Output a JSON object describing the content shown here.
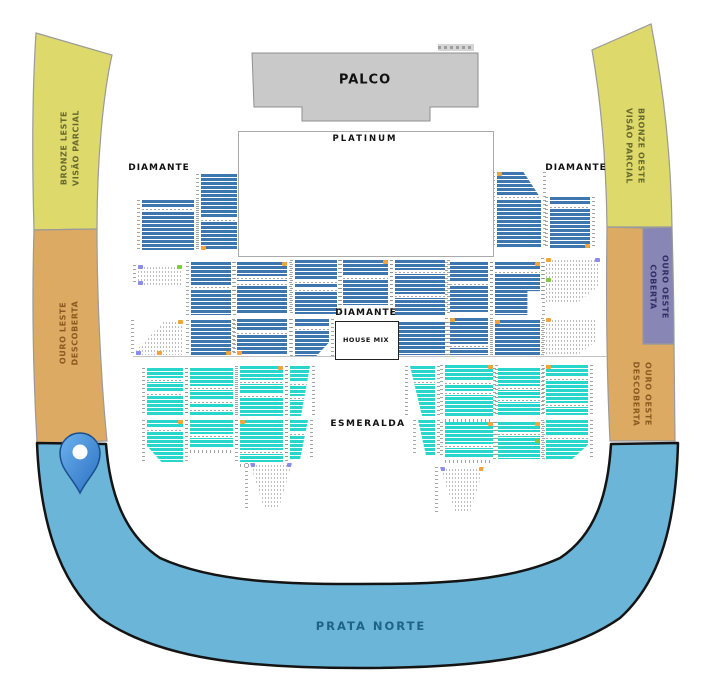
{
  "stage": {
    "label": "PALCO"
  },
  "sections": {
    "platinum": {
      "label": "PLATINUM"
    },
    "diamante_left": {
      "label": "DIAMANTE"
    },
    "diamante_right": {
      "label": "DIAMANTE"
    },
    "diamante_center": {
      "label": "DIAMANTE"
    },
    "house_mix": {
      "label": "HOUSE MIX"
    },
    "esmeralda": {
      "label": "ESMERALDA"
    },
    "prata_norte": {
      "label": "PRATA NORTE"
    },
    "bronze_leste": {
      "line1": "BRONZE LESTE",
      "line2": "VISÃO PARCIAL"
    },
    "bronze_oeste": {
      "line1": "BRONZE OESTE",
      "line2": "VISÃO PARCIAL"
    },
    "ouro_leste": {
      "line1": "OURO LESTE",
      "line2": "DESCOBERTA"
    },
    "ouro_oeste_coberta": {
      "line1": "OURO OESTE",
      "line2": "COBERTA"
    },
    "ouro_oeste_descoberta": {
      "line1": "OURO OESTE",
      "line2": "DESCOBERTA"
    }
  },
  "colors": {
    "gold": "#bf9c1c",
    "blue": "#3e76af",
    "cyan": "#28d7cc",
    "bronze_band": "#ddd96b",
    "ouro_band": "#dcaa63",
    "coberta_band": "#8886b4",
    "prata_band": "#6ab5d8",
    "stage_fill": "#c9c9c9",
    "pin_light": "#6db2ee",
    "pin_dark": "#2a6fc0",
    "pin_stroke": "#1b4e8c",
    "accent_orange": "#f2a33c",
    "accent_green": "#7ecb3f",
    "accent_purple": "#8b8bef"
  },
  "marker": {
    "name": "selected-location-pin"
  },
  "seat_blocks": [
    {
      "x": 245,
      "y": 152,
      "w": 40,
      "h": 48,
      "c": "gold",
      "shape": "cut-tl",
      "gaps": [
        16
      ],
      "acc": [
        [
          "tr",
          "o"
        ]
      ]
    },
    {
      "x": 293,
      "y": 148,
      "w": 42,
      "h": 52,
      "c": "gold",
      "gaps": [
        30
      ],
      "hd": "t"
    },
    {
      "x": 342,
      "y": 147,
      "w": 43,
      "h": 53,
      "c": "gold",
      "gaps": [
        5,
        10
      ],
      "hd": "t"
    },
    {
      "x": 393,
      "y": 148,
      "w": 42,
      "h": 52,
      "c": "gold",
      "gaps": [
        22,
        36
      ],
      "hd": "t"
    },
    {
      "x": 442,
      "y": 147,
      "w": 43,
      "h": 53,
      "c": "gold",
      "shape": "cut-tr",
      "gaps": [
        14
      ],
      "acc": [
        [
          "tl",
          "o"
        ]
      ]
    },
    {
      "x": 245,
      "y": 205,
      "w": 40,
      "h": 42,
      "c": "gold"
    },
    {
      "x": 293,
      "y": 205,
      "w": 42,
      "h": 42,
      "c": "gold",
      "gaps": [
        24
      ]
    },
    {
      "x": 342,
      "y": 205,
      "w": 43,
      "h": 42,
      "c": "gold",
      "gaps": [
        8
      ]
    },
    {
      "x": 393,
      "y": 205,
      "w": 42,
      "h": 42,
      "c": "gold",
      "gaps": [
        28
      ],
      "acc": [
        [
          "tr",
          "o"
        ]
      ]
    },
    {
      "x": 442,
      "y": 205,
      "w": 43,
      "h": 42,
      "c": "gold",
      "gaps": [
        16
      ]
    },
    {
      "x": 142,
      "y": 200,
      "w": 52,
      "h": 50,
      "c": "blue",
      "gaps": [
        7
      ]
    },
    {
      "x": 201,
      "y": 174,
      "w": 36,
      "h": 76,
      "c": "blue",
      "gaps": [
        44
      ],
      "acc": [
        [
          "bl",
          "o"
        ]
      ]
    },
    {
      "x": 497,
      "y": 172,
      "w": 44,
      "h": 76,
      "c": "blue",
      "shape": "cut-tr",
      "gaps": [
        23
      ],
      "acc": [
        [
          "tl",
          "o"
        ]
      ]
    },
    {
      "x": 550,
      "y": 197,
      "w": 40,
      "h": 51,
      "c": "blue",
      "gaps": [
        8
      ],
      "acc": [
        [
          "br",
          "o"
        ]
      ]
    },
    {
      "x": 138,
      "y": 265,
      "w": 44,
      "h": 20,
      "dots": 1,
      "acc": [
        [
          "tl",
          "p"
        ],
        [
          "bl",
          "p"
        ],
        [
          "tr",
          "g"
        ]
      ]
    },
    {
      "x": 191,
      "y": 262,
      "w": 40,
      "h": 53,
      "c": "blue",
      "gaps": [
        23
      ]
    },
    {
      "x": 136,
      "y": 320,
      "w": 47,
      "h": 35,
      "dots": 1,
      "shape": "diag-tl",
      "acc": [
        [
          "tr",
          "o"
        ],
        [
          "bl",
          "p"
        ],
        [
          "bm",
          "o"
        ]
      ]
    },
    {
      "x": 191,
      "y": 320,
      "w": 40,
      "h": 35,
      "c": "blue",
      "acc": [
        [
          "br",
          "o"
        ]
      ]
    },
    {
      "x": 237,
      "y": 262,
      "w": 50,
      "h": 51,
      "c": "blue",
      "gaps": [
        14,
        20
      ],
      "acc": [
        [
          "tr",
          "o"
        ]
      ]
    },
    {
      "x": 237,
      "y": 319,
      "w": 50,
      "h": 36,
      "c": "blue",
      "gaps": [
        12
      ],
      "acc": [
        [
          "bl",
          "o"
        ]
      ]
    },
    {
      "x": 295,
      "y": 260,
      "w": 42,
      "h": 54,
      "c": "blue",
      "gaps": [
        20,
        28
      ]
    },
    {
      "x": 295,
      "y": 319,
      "w": 34,
      "h": 38,
      "c": "blue",
      "shape": "cut-br",
      "gaps": [
        8
      ]
    },
    {
      "x": 343,
      "y": 260,
      "w": 45,
      "h": 45,
      "c": "blue",
      "gaps": [
        16
      ],
      "acc": [
        [
          "tr",
          "o"
        ]
      ]
    },
    {
      "x": 395,
      "y": 260,
      "w": 50,
      "h": 55,
      "c": "blue",
      "gaps": [
        10,
        34
      ]
    },
    {
      "x": 395,
      "y": 322,
      "w": 50,
      "h": 33,
      "c": "blue"
    },
    {
      "x": 450,
      "y": 262,
      "w": 38,
      "h": 50,
      "c": "blue",
      "gaps": [
        20
      ]
    },
    {
      "x": 450,
      "y": 318,
      "w": 38,
      "h": 37,
      "c": "blue",
      "gaps": [
        26
      ],
      "acc": [
        [
          "tl",
          "o"
        ]
      ]
    },
    {
      "x": 495,
      "y": 262,
      "w": 45,
      "h": 53,
      "c": "blue",
      "shape": "step-br",
      "gaps": [
        8
      ],
      "acc": [
        [
          "tr",
          "o"
        ]
      ]
    },
    {
      "x": 495,
      "y": 320,
      "w": 45,
      "h": 35,
      "c": "blue",
      "acc": [
        [
          "tl",
          "o"
        ]
      ]
    },
    {
      "x": 546,
      "y": 258,
      "w": 54,
      "h": 44,
      "dots": 1,
      "shape": "cut-br",
      "acc": [
        [
          "tl",
          "o"
        ],
        [
          "tr",
          "p"
        ],
        [
          "ml",
          "g"
        ]
      ]
    },
    {
      "x": 546,
      "y": 318,
      "w": 50,
      "h": 38,
      "dots": 1,
      "shape": "cut-br",
      "acc": [
        [
          "tl",
          "o"
        ],
        [
          "br",
          "p"
        ]
      ]
    },
    {
      "x": 147,
      "y": 368,
      "w": 36,
      "h": 47,
      "c": "cyan",
      "gaps": [
        10,
        24
      ]
    },
    {
      "x": 147,
      "y": 420,
      "w": 36,
      "h": 42,
      "c": "cyan",
      "shape": "cut-bl",
      "gaps": [
        8
      ],
      "acc": [
        [
          "tr",
          "o"
        ]
      ]
    },
    {
      "x": 190,
      "y": 368,
      "w": 43,
      "h": 47,
      "c": "cyan",
      "gaps": [
        18,
        32,
        40
      ]
    },
    {
      "x": 190,
      "y": 420,
      "w": 43,
      "h": 28,
      "c": "cyan",
      "gaps": [
        14
      ],
      "hd": "b"
    },
    {
      "x": 240,
      "y": 366,
      "w": 43,
      "h": 50,
      "c": "cyan",
      "gaps": [
        14,
        28
      ],
      "acc": [
        [
          "tr",
          "o"
        ]
      ]
    },
    {
      "x": 240,
      "y": 420,
      "w": 43,
      "h": 42,
      "c": "cyan",
      "gaps": [
        30
      ],
      "acc": [
        [
          "tl",
          "o"
        ]
      ],
      "hd": "b"
    },
    {
      "x": 290,
      "y": 366,
      "w": 20,
      "h": 50,
      "c": "cyan",
      "shape": "taper-r",
      "gaps": [
        16,
        30
      ]
    },
    {
      "x": 290,
      "y": 420,
      "w": 18,
      "h": 40,
      "c": "cyan",
      "shape": "taper-r",
      "gaps": [
        12
      ]
    },
    {
      "x": 410,
      "y": 366,
      "w": 25,
      "h": 50,
      "c": "cyan",
      "shape": "taper-l",
      "gaps": [
        14
      ]
    },
    {
      "x": 418,
      "y": 420,
      "w": 17,
      "h": 36,
      "c": "cyan",
      "shape": "taper-l"
    },
    {
      "x": 445,
      "y": 365,
      "w": 48,
      "h": 52,
      "c": "cyan",
      "gaps": [
        16,
        26
      ],
      "acc": [
        [
          "tr",
          "o"
        ]
      ],
      "hd": "b"
    },
    {
      "x": 445,
      "y": 422,
      "w": 48,
      "h": 36,
      "c": "cyan",
      "gaps": [
        22
      ],
      "acc": [
        [
          "tr",
          "o"
        ]
      ],
      "hd": "b"
    },
    {
      "x": 498,
      "y": 368,
      "w": 42,
      "h": 48,
      "c": "cyan",
      "gaps": [
        18,
        30
      ]
    },
    {
      "x": 498,
      "y": 422,
      "w": 42,
      "h": 37,
      "c": "cyan",
      "gaps": [
        10
      ],
      "acc": [
        [
          "tr",
          "o"
        ],
        [
          "mr",
          "g"
        ]
      ]
    },
    {
      "x": 546,
      "y": 365,
      "w": 42,
      "h": 50,
      "c": "cyan",
      "gaps": [
        12,
        38
      ],
      "acc": [
        [
          "tl",
          "o"
        ]
      ]
    },
    {
      "x": 546,
      "y": 420,
      "w": 42,
      "h": 40,
      "c": "cyan",
      "shape": "cut-br",
      "gaps": [
        16
      ]
    },
    {
      "x": 250,
      "y": 463,
      "w": 42,
      "h": 46,
      "dots": 1,
      "shape": "tri-b",
      "acc": [
        [
          "tl",
          "p"
        ],
        [
          "tr",
          "p"
        ],
        [
          "ml",
          "o"
        ]
      ]
    },
    {
      "x": 440,
      "y": 467,
      "w": 44,
      "h": 45,
      "dots": 1,
      "shape": "tri-b",
      "acc": [
        [
          "tl",
          "p"
        ],
        [
          "tr",
          "o"
        ],
        [
          "mr",
          "g"
        ],
        [
          "br",
          "p"
        ]
      ]
    }
  ]
}
